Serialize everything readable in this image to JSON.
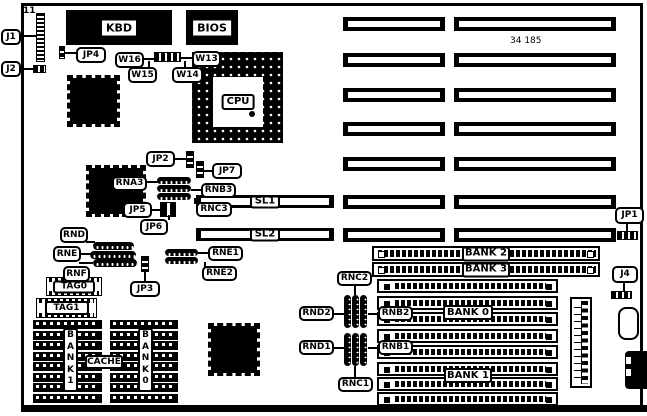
{
  "diagram": {
    "part_number": "34 185",
    "pin_label": "11"
  },
  "callouts": {
    "j1": "J1",
    "j2": "J2",
    "j4": "J4",
    "jp1": "JP1",
    "jp2": "JP2",
    "jp3": "JP3",
    "jp4": "JP4",
    "jp5": "JP5",
    "jp6": "JP6",
    "jp7": "JP7",
    "w13": "W13",
    "w14": "W14",
    "w15": "W15",
    "w16": "W16",
    "rna3": "RNA3",
    "rnb3": "RNB3",
    "rnc3": "RNC3",
    "rnd": "RND",
    "rne": "RNE",
    "rnf": "RNF",
    "rne1": "RNE1",
    "rne2": "RNE2",
    "rnb1": "RNB1",
    "rnb2": "RNB2",
    "rnc1": "RNC1",
    "rnc2": "RNC2",
    "rnd1": "RND1",
    "rnd2": "RND2"
  },
  "chips": {
    "kbd": "KBD",
    "bios": "BIOS",
    "cpu": "CPU",
    "tag0": "TAG0",
    "tag1": "TAG1",
    "cache_label": "CACHE",
    "cache_bank0_vertical": "B\nA\nN\nK\n0",
    "cache_bank1_vertical": "B\nA\nN\nK\n1"
  },
  "slots": {
    "sl1": "SL1",
    "sl2": "SL2",
    "isa_slot_count": 7,
    "simm_socket_count": 8,
    "cache_chips_per_bank": 8
  },
  "memory_banks": {
    "bank0": "BANK 0",
    "bank1": "BANK 1",
    "bank2": "BANK 2",
    "bank3": "BANK 3"
  }
}
